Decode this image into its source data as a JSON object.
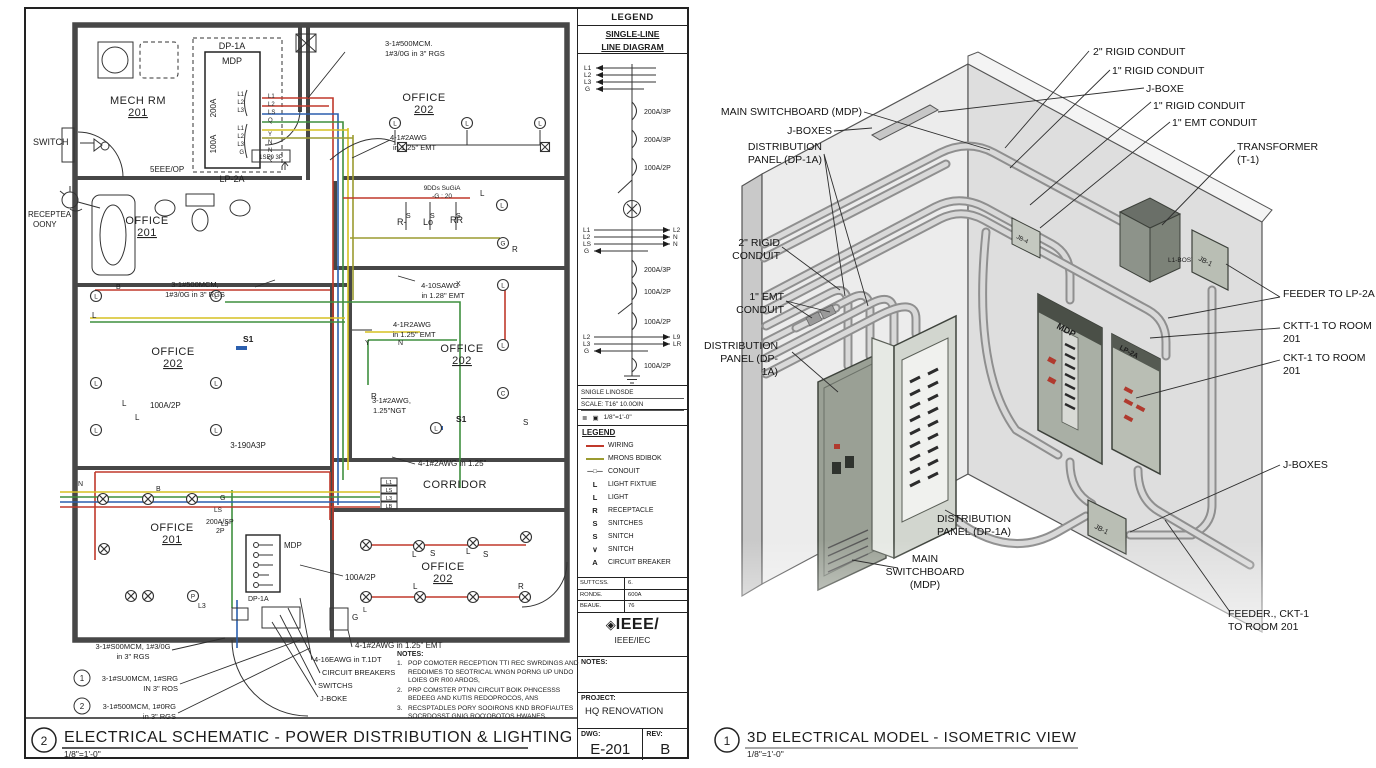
{
  "colors": {
    "wire_red": "#c0392b",
    "wire_green": "#3f8f3f",
    "wire_yellow": "#d6c122",
    "wire_blue": "#2b5fae",
    "wire_olive": "#9b9b30",
    "panel_dark": "#9aa095",
    "panel_light": "#d2d6cf",
    "wall_gray": "#e6e6e6"
  },
  "left_title": {
    "num": "2",
    "title": "ELECTRICAL SCHEMATIC - POWER DISTRIBUTION & LIGHTING",
    "scale": "1/8\"=1'-0\""
  },
  "right_title": {
    "num": "1",
    "title": "3D ELECTRICAL MODEL - ISOMETRIC VIEW",
    "scale": "1/8\"=1'-0\""
  },
  "plan": {
    "switch": "SWITCH",
    "recep1": "RECEPTEA",
    "recep2": "OONY",
    "mech1": "MECH RM",
    "mech2": "201",
    "dp1a": "DP-1A",
    "mdp": "MDP",
    "lp2a": "LP-2A",
    "a200": "200A",
    "a100": "100A",
    "eee": "5EEE/OP",
    "brk150": "1SE0 3P",
    "off201t1": "OFFICE",
    "off201t2": "201",
    "off202a1": "OFFICE",
    "off202a2": "202",
    "mcmA1": "3-1#500MCM.",
    "mcmA2": "1#3/0G in 3\" RGS",
    "awgA1": "4-1#2AWG",
    "awgA2": "in 1.25\" EMT",
    "misc1": "9DDs SuGiA",
    "misc2": "-G : 20",
    "rminus": "R-",
    "lo": "Lo",
    "rr": "RR",
    "mcmB1": "3-1#500MCM,",
    "mcmB2": "1#3/0G in 3\" RGS",
    "awgB1": "4-10SAWG",
    "awgB2": "in 1.28\" EMT",
    "awgC1": "4-1R2AWG",
    "awgC2": "in 1.25\" EMT",
    "off202b1": "OFFICE",
    "off202b2": "202",
    "off202c1": "OFFICE",
    "off202c2": "202",
    "a100b": "100A/2P",
    "a100c": "100A/2P",
    "ngt1": "3-1#2AWG,",
    "ngt2": "1.25\"NGT",
    "s1a": "S1",
    "s1b": "S1",
    "a3p": "3-190A3P",
    "awgD": "4-1#2AWG in 1.25\"",
    "corridor": "CORRIDOR",
    "off201b1": "OFFICE",
    "off201b2": "201",
    "a200sp": "200A/SP",
    "p2": "2P",
    "mdpB": "MDP",
    "dp1aB": "DP-1A",
    "off202d1": "OFFICE",
    "off202d2": "202",
    "l3": "L3",
    "gbox": "G",
    "wiretag1": "L1",
    "wiretag2": "LS",
    "wiretag3": "L3",
    "wiretag4": "LB",
    "mcmC1": "3-1#S00MCM, 1#3/0G",
    "mcmC2": "in 3\" RGS",
    "c1n": "1",
    "c1a": "3-1#SU0MCM, 1#SRG",
    "c1b": "IN 3\" ROS",
    "c2n": "2",
    "c2a": "3-1#500MCM, 1#0RG",
    "c2b": "in 3\" RGS",
    "awgE": "4-1#2AWG in 1.25\" EMT",
    "awgF": "4-16EAWG in T.1DT",
    "cb": "CIRCUIT BREAKERS",
    "sw": "SWITCHS",
    "jb": "J-BOKE",
    "scatter": [
      {
        "x": 116,
        "y": 289,
        "t": "B",
        "s": 7
      },
      {
        "x": 456,
        "y": 286,
        "t": "X",
        "s": 7
      },
      {
        "x": 406,
        "y": 218,
        "t": "S",
        "s": 7
      },
      {
        "x": 430,
        "y": 218,
        "t": "S",
        "s": 7
      },
      {
        "x": 456,
        "y": 218,
        "t": "S",
        "s": 7
      },
      {
        "x": 480,
        "y": 196,
        "t": "L",
        "s": 8
      },
      {
        "x": 512,
        "y": 252,
        "t": "R",
        "s": 8
      },
      {
        "x": 365,
        "y": 345,
        "t": "Y",
        "s": 7
      },
      {
        "x": 398,
        "y": 345,
        "t": "N",
        "s": 7
      },
      {
        "x": 371,
        "y": 399,
        "t": "R",
        "s": 8
      },
      {
        "x": 523,
        "y": 425,
        "t": "S",
        "s": 8
      },
      {
        "x": 78,
        "y": 486,
        "t": "N",
        "s": 7
      },
      {
        "x": 220,
        "y": 500,
        "t": "G",
        "s": 7
      },
      {
        "x": 214,
        "y": 512,
        "t": "LS",
        "s": 6.5
      },
      {
        "x": 221,
        "y": 526,
        "t": "L3",
        "s": 6.5
      },
      {
        "x": 412,
        "y": 557,
        "t": "L",
        "s": 8
      },
      {
        "x": 430,
        "y": 556,
        "t": "S",
        "s": 8
      },
      {
        "x": 466,
        "y": 554,
        "t": "L",
        "s": 8
      },
      {
        "x": 483,
        "y": 557,
        "t": "S",
        "s": 8
      },
      {
        "x": 413,
        "y": 589,
        "t": "L",
        "s": 8
      },
      {
        "x": 518,
        "y": 589,
        "t": "R",
        "s": 8
      },
      {
        "x": 363,
        "y": 612,
        "t": "L",
        "s": 7
      },
      {
        "x": 352,
        "y": 620,
        "t": "G",
        "s": 8
      },
      {
        "x": 92,
        "y": 318,
        "t": "L",
        "s": 8
      },
      {
        "x": 122,
        "y": 406,
        "t": "L",
        "s": 8
      },
      {
        "x": 135,
        "y": 420,
        "t": "L",
        "s": 8
      },
      {
        "x": 156,
        "y": 491,
        "t": "B",
        "s": 7
      },
      {
        "x": 198,
        "y": 608,
        "t": "L3",
        "s": 7
      },
      {
        "x": 244,
        "y": 96,
        "t": "L1",
        "s": 6,
        "a": "end"
      },
      {
        "x": 244,
        "y": 104,
        "t": "L2",
        "s": 6,
        "a": "end"
      },
      {
        "x": 244,
        "y": 112,
        "t": "L3",
        "s": 6,
        "a": "end"
      },
      {
        "x": 244,
        "y": 130,
        "t": "L1",
        "s": 6,
        "a": "end"
      },
      {
        "x": 244,
        "y": 138,
        "t": "L2",
        "s": 6,
        "a": "end"
      },
      {
        "x": 244,
        "y": 146,
        "t": "L3",
        "s": 6,
        "a": "end"
      },
      {
        "x": 244,
        "y": 154,
        "t": "G",
        "s": 6,
        "a": "end"
      },
      {
        "x": 268,
        "y": 98,
        "t": "L1",
        "s": 6
      },
      {
        "x": 268,
        "y": 106,
        "t": "L2",
        "s": 6
      },
      {
        "x": 268,
        "y": 114,
        "t": "LS",
        "s": 6
      },
      {
        "x": 268,
        "y": 122,
        "t": "Q",
        "s": 6
      },
      {
        "x": 268,
        "y": 136,
        "t": "Y",
        "s": 6
      },
      {
        "x": 268,
        "y": 144,
        "t": "N",
        "s": 6
      },
      {
        "x": 268,
        "y": 152,
        "t": "N",
        "s": 6
      },
      {
        "x": 268,
        "y": 160,
        "t": "Q",
        "s": 6
      }
    ],
    "symbols": [
      {
        "k": "cl",
        "x": 395,
        "y": 123,
        "t": "L"
      },
      {
        "k": "cl",
        "x": 467,
        "y": 123,
        "t": "L"
      },
      {
        "k": "cl",
        "x": 540,
        "y": 123,
        "t": "L"
      },
      {
        "k": "bx",
        "x": 402,
        "y": 147
      },
      {
        "k": "bx",
        "x": 545,
        "y": 147
      },
      {
        "k": "cl",
        "x": 502,
        "y": 205,
        "t": "L"
      },
      {
        "k": "cl",
        "x": 503,
        "y": 243,
        "t": "G"
      },
      {
        "k": "cl",
        "x": 96,
        "y": 296,
        "t": "L"
      },
      {
        "k": "cl",
        "x": 216,
        "y": 296,
        "t": "L"
      },
      {
        "k": "cl",
        "x": 96,
        "y": 383,
        "t": "L"
      },
      {
        "k": "cl",
        "x": 216,
        "y": 383,
        "t": "L"
      },
      {
        "k": "cl",
        "x": 96,
        "y": 430,
        "t": "L"
      },
      {
        "k": "cl",
        "x": 216,
        "y": 430,
        "t": "L"
      },
      {
        "k": "cl",
        "x": 436,
        "y": 428,
        "t": "L"
      },
      {
        "k": "cl",
        "x": 503,
        "y": 285,
        "t": "L"
      },
      {
        "k": "cl",
        "x": 503,
        "y": 345,
        "t": "L"
      },
      {
        "k": "cl",
        "x": 503,
        "y": 393,
        "t": "C"
      },
      {
        "k": "ot",
        "x": 103,
        "y": 499
      },
      {
        "k": "ot",
        "x": 148,
        "y": 499
      },
      {
        "k": "ot",
        "x": 192,
        "y": 499
      },
      {
        "k": "ot",
        "x": 104,
        "y": 549
      },
      {
        "k": "ot",
        "x": 131,
        "y": 596
      },
      {
        "k": "ot",
        "x": 148,
        "y": 596
      },
      {
        "k": "cl",
        "x": 193,
        "y": 596,
        "t": "P"
      },
      {
        "k": "ot",
        "x": 366,
        "y": 545
      },
      {
        "k": "ot",
        "x": 419,
        "y": 546
      },
      {
        "k": "ot",
        "x": 473,
        "y": 543
      },
      {
        "k": "ot",
        "x": 526,
        "y": 537
      },
      {
        "k": "ot",
        "x": 366,
        "y": 597
      },
      {
        "k": "ot",
        "x": 420,
        "y": 597
      },
      {
        "k": "ot",
        "x": 473,
        "y": 597
      },
      {
        "k": "ot",
        "x": 525,
        "y": 597
      }
    ]
  },
  "titleblock": {
    "legend_hdr": "LEGEND",
    "sld1": "SINGLE-LINE",
    "sld2": "LINE DIAGRAM",
    "ph1": "L1",
    "ph2": "L2",
    "ph3": "L3",
    "ph4": "G",
    "brk1": "200A/3P",
    "brk2": "200A/3P",
    "brk3": "100A/2P",
    "brk4": "200A/3P",
    "brk5": "100A/2P",
    "brk6": "100A/2P",
    "brk7": "100A/2P",
    "ml1": "L1",
    "ml2": "L2",
    "ml3": "LS",
    "ml4": "G",
    "mr1": "L2",
    "mr2": "N",
    "mr3": "N",
    "ll1": "L2",
    "ll2": "L3",
    "ll3": "G",
    "lr1": "L9",
    "lr2": "LR",
    "foot1": "SNIGLE LINOSDE",
    "foot2": "SCALE: T16\" 10.0OIN",
    "scale_row": "1/8\"=1'-0\"",
    "sym_a": "≣",
    "sym_b": "▣",
    "legend2_hdr": "LEGEND",
    "items": [
      {
        "sym": "",
        "label": "WIRING"
      },
      {
        "sym": "",
        "label": "MRONS BDIBOK"
      },
      {
        "sym": "—□—",
        "label": "CONOUIT"
      },
      {
        "sym": "L",
        "label": "LIGHT FIXTUIE"
      },
      {
        "sym": "L",
        "label": "LIGHT"
      },
      {
        "sym": "R",
        "label": "RECEPTACLE"
      },
      {
        "sym": "S",
        "label": "SNITCHES"
      },
      {
        "sym": "S",
        "label": "SNITCH"
      },
      {
        "sym": "∨",
        "label": "SNITCH"
      },
      {
        "sym": "A",
        "label": "CIRCUIT BREAKER"
      }
    ],
    "table": [
      [
        "SUTTCSS.",
        "6."
      ],
      [
        "RONDE.",
        "600A"
      ],
      [
        "BEAUE.",
        "76"
      ]
    ],
    "logo_dia": "◈",
    "logo_main": "IEEE/",
    "logo_sub": "IEEE/IEC",
    "notes_lbl": "NOTES:",
    "project_lbl": "PROJECT:",
    "project": "HQ RENOVATION",
    "dwg_lbl": "DWG:",
    "dwg": "E-201",
    "rev_lbl": "REV:",
    "rev": "B"
  },
  "notes": {
    "title": "NOTES:",
    "n1": "1.",
    "t1": "POP COMOTER RECEPTION TTI REC SWRDINGS AND REDDIMES TO SEOTRICAL WNGN PORNG UP UNDO LOIES OR R00 ARDOS,",
    "n2": "2.",
    "t2": "PRP COMSTER PTNN CIRCUIT BOIK PHNCESSS BEDEEG AND KUTIS REDOPROCOS, ANS",
    "n3": "3.",
    "t3": "RECSPTADLES PORY SOOIRONS KND BROFIAUTES SOCRDOSST GNIG ROO'OBOTOS HWANES."
  },
  "iso": {
    "t1": "2\" RIGID CONDUIT",
    "t2": "1\" RIGID CONDUIT",
    "t3": "J-BOXE",
    "t4": "1\" RIGID CONDUIT",
    "t5": "1\" EMT CONDUIT",
    "t6": "TRANSFORMER (T-1)",
    "l1": "MAIN SWITCHBOARD (MDP)",
    "l2": "J-BOXES",
    "l3": "DISTRIBUTION PANEL (DP-1A)",
    "l4": "2\" RIGID CONDUIT",
    "l5": "1\" EMT CONDUIT",
    "l6": "DISTRIBUTION PANEL (DP-1A)",
    "r1": "FEEDER TO LP-2A",
    "r2": "CKTT-1 TO ROOM 201",
    "r3": "CKT-1 TO ROOM 201",
    "r4": "J-BOXES",
    "r5": "FEEDER., CKT-1 TO ROOM 201",
    "b1": "DISTRIBUTION PANEL (DP-1A)",
    "b2": "MAIN SWITCHBOARD (MDP)",
    "model": {
      "mdp": "MDP",
      "lp2a": "LP-2A",
      "jb1a": "JB-1",
      "jb1b": "JB-1",
      "jb4": "JB-4",
      "tbost": "L1-BOST"
    }
  }
}
